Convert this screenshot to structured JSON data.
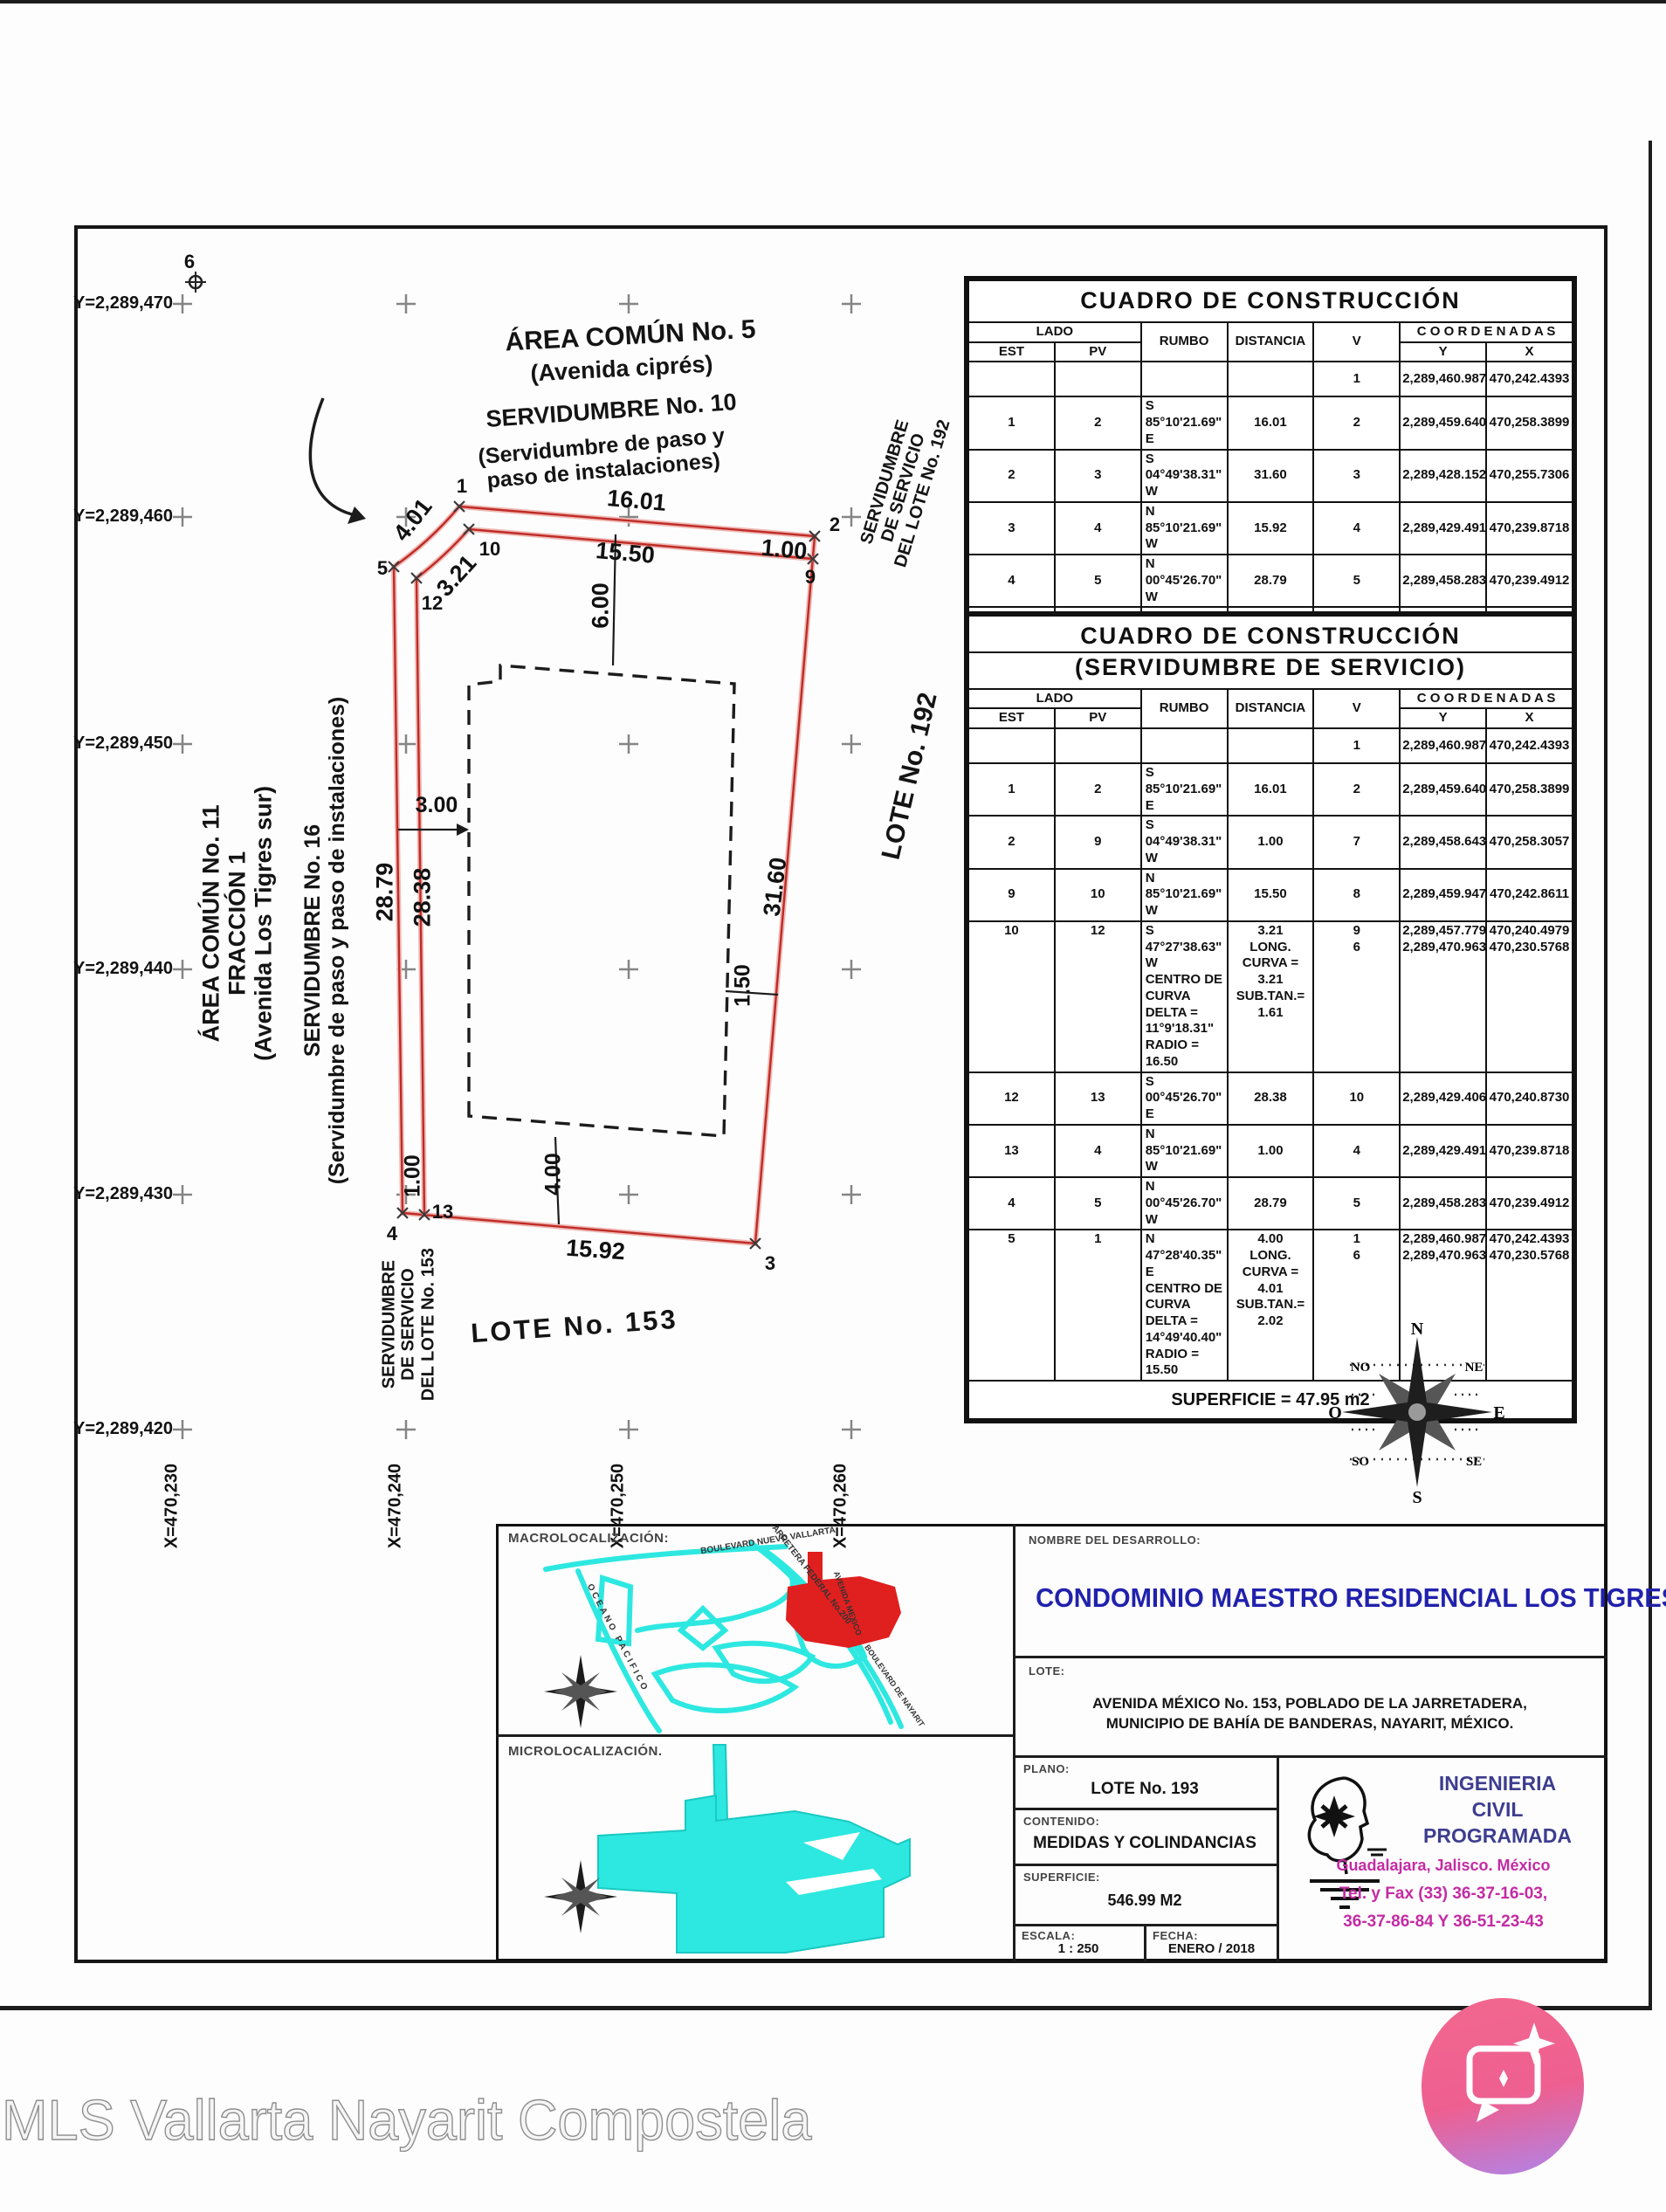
{
  "watermark": "MLS Vallarta Nayarit Compostela",
  "colors": {
    "plot_red": "#bf2b26",
    "map_cyan": "#2de8e0",
    "title_blue": "#2121ad",
    "magenta": "#c42ba4",
    "navy": "#3d3d8f"
  },
  "plot": {
    "labels": {
      "area5_title": "ÁREA COMÚN No. 5",
      "area5_sub": "(Avenida ciprés)",
      "serv10_title": "SERVIDUMBRE No. 10",
      "serv10_sub": "(Servidumbre de paso y\npaso de instalaciones)",
      "area11": "ÁREA COMÚN No. 11\nFRACCIÓN 1\n(Avenida Los Tigres sur)",
      "serv16": "SERVIDUMBRE No. 16\n(Servidumbre de paso y paso de instalaciones)",
      "serv192": "SERVIDUMBRE\nDE SERVICIO\nDEL LOTE No. 192",
      "lote192": "LOTE No. 192",
      "serv153": "SERVIDUMBRE\nDE SERVICIO\nDEL LOTE No. 153",
      "lote153": "LOTE No. 153"
    },
    "dims": {
      "top": "16.01",
      "inner_top": "15.50",
      "right_top": "1.00",
      "pad_top": "6.00",
      "curve_outer": "4.01",
      "curve_inner": "3.21",
      "left_outer": "28.79",
      "left_inner": "28.38",
      "pad_left": "3.00",
      "right_side": "31.60",
      "pad_right": "1.50",
      "bottom_left": "1.00",
      "pad_bottom": "4.00",
      "bottom": "15.92"
    },
    "vertices": {
      "v1": "1",
      "v2": "2",
      "v3": "3",
      "v4": "4",
      "v5": "5",
      "v6": "6",
      "v9": "9",
      "v10": "10",
      "v12": "12",
      "v13": "13"
    },
    "axis": {
      "y": [
        "Y=2,289,470",
        "Y=2,289,460",
        "Y=2,289,450",
        "Y=2,289,440",
        "Y=2,289,430",
        "Y=2,289,420"
      ],
      "x": [
        "X=470,230",
        "X=470,240",
        "X=470,250",
        "X=470,260"
      ]
    }
  },
  "tables": {
    "t1": {
      "title": "CUADRO DE CONSTRUCCIÓN",
      "headers": {
        "lado": "LADO",
        "est": "EST",
        "pv": "PV",
        "rumbo": "RUMBO",
        "distancia": "DISTANCIA",
        "v": "V",
        "coordenadas": "C O O R D E N A D A S",
        "y": "Y",
        "x": "X"
      },
      "rows": [
        [
          "",
          "",
          "",
          "",
          "1",
          "2,289,460.9871",
          "470,242.4393"
        ],
        [
          "1",
          "2",
          "S 85°10'21.69\" E",
          "16.01",
          "2",
          "2,289,459.6401",
          "470,258.3899"
        ],
        [
          "2",
          "3",
          "S 04°49'38.31\" W",
          "31.60",
          "3",
          "2,289,428.1521",
          "470,255.7306"
        ],
        [
          "3",
          "4",
          "N 85°10'21.69\" W",
          "15.92",
          "4",
          "2,289,429.4915",
          "470,239.8718"
        ],
        [
          "4",
          "5",
          "N 00°45'26.70\" W",
          "28.79",
          "5",
          "2,289,458.2835",
          "470,239.4912"
        ],
        [
          "5",
          "1",
          "N 47°28'40.35\" E\nCENTRO DE CURVA\nDELTA = 14°49'40.40\"\nRADIO = 15.50",
          "4.00\nLONG. CURVA = 4.01\nSUB.TAN.= 2.02",
          "1\n6",
          "2,289,460.9871\n2,289,470.9636",
          "470,242.4393\n470,230.5768"
        ]
      ]
    },
    "t2": {
      "title": "CUADRO DE CONSTRUCCIÓN",
      "subtitle": "(SERVIDUMBRE DE SERVICIO)",
      "headers": {
        "lado": "LADO",
        "est": "EST",
        "pv": "PV",
        "rumbo": "RUMBO",
        "distancia": "DISTANCIA",
        "v": "V",
        "coordenadas": "C O O R D E N A D A S",
        "y": "Y",
        "x": "X"
      },
      "rows": [
        [
          "",
          "",
          "",
          "",
          "1",
          "2,289,460.9871",
          "470,242.4393"
        ],
        [
          "1",
          "2",
          "S 85°10'21.69\" E",
          "16.01",
          "2",
          "2,289,459.6401",
          "470,258.3899"
        ],
        [
          "2",
          "9",
          "S 04°49'38.31\" W",
          "1.00",
          "7",
          "2,289,458.6436",
          "470,258.3057"
        ],
        [
          "9",
          "10",
          "N 85°10'21.69\" W",
          "15.50",
          "8",
          "2,289,459.9479",
          "470,242.8611"
        ],
        [
          "10",
          "12",
          "S 47°27'38.63\" W\nCENTRO DE CURVA\nDELTA = 11°9'18.31\"\nRADIO = 16.50",
          "3.21\nLONG. CURVA = 3.21\nSUB.TAN.= 1.61",
          "9\n6",
          "2,289,457.7795\n2,289,470.9636",
          "470,240.4979\n470,230.5768"
        ],
        [
          "12",
          "13",
          "S 00°45'26.70\" E",
          "28.38",
          "10",
          "2,289,429.4069",
          "470,240.8730"
        ],
        [
          "13",
          "4",
          "N 85°10'21.69\" W",
          "1.00",
          "4",
          "2,289,429.4915",
          "470,239.8718"
        ],
        [
          "4",
          "5",
          "N 00°45'26.70\" W",
          "28.79",
          "5",
          "2,289,458.2835",
          "470,239.4912"
        ],
        [
          "5",
          "1",
          "N 47°28'40.35\" E\nCENTRO DE CURVA\nDELTA = 14°49'40.40\"\nRADIO = 15.50",
          "4.00\nLONG. CURVA = 4.01\nSUB.TAN.= 2.02",
          "1\n6",
          "2,289,460.9871\n2,289,470.9636",
          "470,242.4393\n470,230.5768"
        ]
      ],
      "superficie": "SUPERFICIE = 47.95 m2"
    }
  },
  "compass": {
    "n": "N",
    "s": "S",
    "e": "E",
    "o": "O",
    "no": "NO",
    "ne": "NE",
    "so": "SO",
    "se": "SE"
  },
  "maps": {
    "macro_label": "MACROLOCALIZACIÓN:",
    "micro_label": "MICROLOCALIZACIÓN.",
    "roads": [
      "BOULEVARD NUEVO VALLARTA",
      "CARRETERA FEDERAL No.200",
      "OCEANO PACIFICO",
      "AVENIDA MEXICO",
      "BOULEVARD DE NAYARIT"
    ]
  },
  "title_block": {
    "nombre_label": "NOMBRE DEL DESARROLLO:",
    "nombre": "CONDOMINIO MAESTRO RESIDENCIAL LOS TIGRES",
    "lote_label": "LOTE:",
    "lote_address": "AVENIDA MÉXICO No. 153, POBLADO DE LA JARRETADERA,\nMUNICIPIO DE BAHÍA DE BANDERAS, NAYARIT, MÉXICO.",
    "plano_label": "PLANO:",
    "plano": "LOTE No. 193",
    "contenido_label": "CONTENIDO:",
    "contenido": "MEDIDAS Y COLINDANCIAS",
    "superficie_label": "SUPERFICIE:",
    "superficie": "546.99 M2",
    "escala_label": "ESCALA:",
    "escala": "1 : 250",
    "fecha_label": "FECHA:",
    "fecha": "ENERO / 2018",
    "firm": {
      "line1": "INGENIERIA",
      "line2": "CIVIL",
      "line3": "PROGRAMADA",
      "city": "Guadalajara, Jalisco. México",
      "tel1": "Tel. y Fax (33) 36-37-16-03,",
      "tel2": "36-37-86-84 Y 36-51-23-43"
    }
  }
}
